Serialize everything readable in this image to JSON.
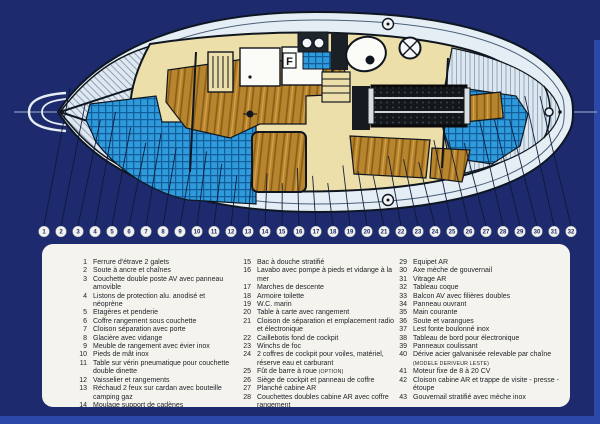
{
  "colors": {
    "navy": "#1d2b6e",
    "edge": "#2b49a6",
    "panel": "#f4f3ee",
    "cushion_blue": "#2f9bdb",
    "cushion_grid_blue": "#135f9e",
    "wood_brown": "#b8852f",
    "hull_cream": "#ecdfa9",
    "deck_white": "#e6eef5",
    "outline_dark": "#10161f"
  },
  "diagram": {
    "description": "Vue en plan de l'aménagement intérieur d'un voilier, étrave à gauche, tableau AR à droite",
    "markers": [
      "1",
      "2",
      "3",
      "4",
      "5",
      "6",
      "7",
      "8",
      "9",
      "10",
      "11",
      "12",
      "13",
      "14",
      "15",
      "16",
      "17",
      "18",
      "19",
      "20",
      "21",
      "22",
      "23",
      "24",
      "25",
      "26",
      "27",
      "28",
      "29",
      "30",
      "31",
      "32"
    ]
  },
  "legend": {
    "columns": [
      {
        "items": [
          {
            "num": "1",
            "text": "Ferrure d'étrave 2 galets"
          },
          {
            "num": "2",
            "text": "Soute à ancre et chaînes"
          },
          {
            "num": "3",
            "text": "Couchette double poste AV avec panneau amovible"
          },
          {
            "num": "4",
            "text": "Listons de protection alu. anodisé et néoprène"
          },
          {
            "num": "5",
            "text": "Etagères et penderie"
          },
          {
            "num": "6",
            "text": "Coffre rangement sous couchette"
          },
          {
            "num": "7",
            "text": "Cloison séparation avec porte"
          },
          {
            "num": "8",
            "text": "Glacière avec vidange"
          },
          {
            "num": "9",
            "text": "Meuble de rangement avec évier inox"
          },
          {
            "num": "10",
            "text": "Pieds de mât inox"
          },
          {
            "num": "11",
            "text": "Table sur vérin pneumatique pour couchette double dinette"
          },
          {
            "num": "12",
            "text": "Vaisselier et rangements"
          },
          {
            "num": "13",
            "text": "Réchaud 2 feux sur cardan avec bouteille camping gaz"
          },
          {
            "num": "14",
            "text": "Moulage support de cadènes"
          }
        ]
      },
      {
        "items": [
          {
            "num": "15",
            "text": "Bac à douche stratifié"
          },
          {
            "num": "16",
            "text": "Lavabo avec pompe à pieds et vidange à la mer"
          },
          {
            "num": "17",
            "text": "Marches de descente"
          },
          {
            "num": "18",
            "text": "Armoire toilette"
          },
          {
            "num": "19",
            "text": "W.C. marin"
          },
          {
            "num": "20",
            "text": "Table à carte avec rangement"
          },
          {
            "num": "21",
            "text": "Cloison de séparation et emplacement radio et électronique"
          },
          {
            "num": "22",
            "text": "Caillebotis fond de cockpit"
          },
          {
            "num": "23",
            "text": "Winchs de foc"
          },
          {
            "num": "24",
            "text": "2 coffres de cockpit pour voiles, matériel, réserve eau et carburant"
          },
          {
            "num": "25",
            "text": "Fût de barre à roue",
            "note": "(OPTION)"
          },
          {
            "num": "26",
            "text": "Siège de cockpit et panneau de coffre"
          },
          {
            "num": "27",
            "text": "Planché cabine AR"
          },
          {
            "num": "28",
            "text": "Couchettes doubles cabine AR avec coffre rangement"
          }
        ]
      },
      {
        "items": [
          {
            "num": "29",
            "text": "Equipet AR"
          },
          {
            "num": "30",
            "text": "Axe mèche de gouvernail"
          },
          {
            "num": "31",
            "text": "Vitrage AR"
          },
          {
            "num": "32",
            "text": "Tableau coque"
          },
          {
            "num": "33",
            "text": "Balcon AV avec filières doubles"
          },
          {
            "num": "34",
            "text": "Panneau ouvrant"
          },
          {
            "num": "35",
            "text": "Main courante"
          },
          {
            "num": "36",
            "text": "Soute et varangues"
          },
          {
            "num": "37",
            "text": "Lest fonte boulonné inox"
          },
          {
            "num": "38",
            "text": "Tableau de bord pour électronique"
          },
          {
            "num": "39",
            "text": "Panneaux coulissant"
          },
          {
            "num": "40",
            "text": "Dérive acier galvanisée relevable par chaîne",
            "note": "(MODELE DERIVEUR LESTE)"
          },
          {
            "num": "41",
            "text": "Moteur fixe de 8 à 20 CV"
          },
          {
            "num": "42",
            "text": "Cloison cabine AR et trappe de visite - presse - étoupe"
          },
          {
            "num": "43",
            "text": "Gouvernail stratifié avec mèche inox"
          }
        ]
      }
    ]
  }
}
